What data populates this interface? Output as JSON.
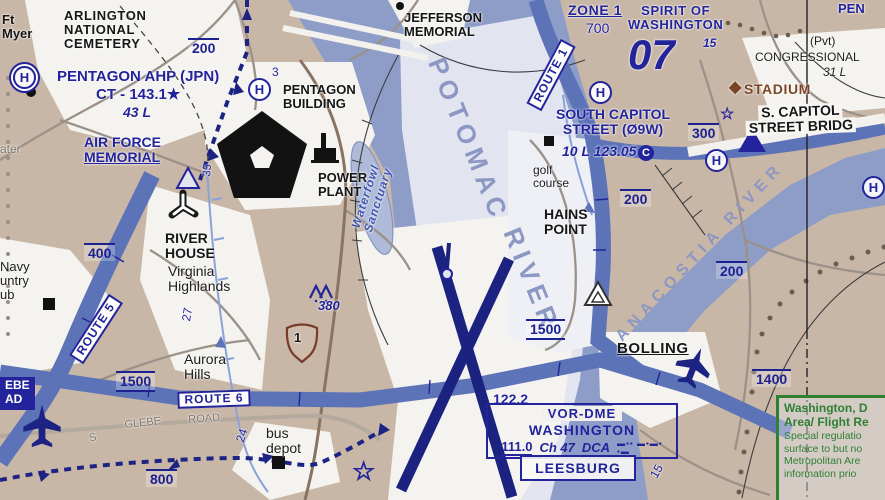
{
  "colors": {
    "land": "#c8b7a7",
    "water": "#8e9dc8",
    "corridor": "#e2e5f0",
    "urban_white": "#f4f3ef",
    "route_band": "#5c73b7",
    "navy": "#23239b",
    "runway": "#1c2280",
    "black": "#161616",
    "brown": "#7c4427",
    "green": "#2e8033",
    "gray_road": "#9b9188",
    "river_label": "#8c97c3"
  },
  "icons": {
    "helipad": "H in circle",
    "star-waypoint": "☆",
    "stadium-diamond": "◆",
    "circled-c": "C",
    "airplane": "plane silhouette",
    "obstacle": "triangle outline",
    "vfr-checkpoint": "nested triangle",
    "obstruction-mountain": "∧∧",
    "pentagon-building": "black pentagon",
    "power-plant": "black building",
    "heliport-runways": "Y shape",
    "us-route-shield": "shield",
    "building-square": "■",
    "building-dot": "●"
  },
  "vor_dme": {
    "title": "VOR-DME",
    "name": "WASHINGTON",
    "freq": "111.0",
    "channel": "Ch 47",
    "ident": "DCA",
    "morse_row1": "▬▪▪ ▬▪▬▪",
    "morse_row2": "▪▬"
  },
  "leesburg": {
    "label": "LEESBURG"
  },
  "frz_note": {
    "lines": [
      "Washington, D",
      "Area/ Flight Re",
      "Special regulatio",
      "surface to but no",
      "Metropolitan Are",
      "information prio"
    ]
  },
  "labels": [
    {
      "id": "ft-myer",
      "lines": [
        "Ft",
        "Myer"
      ],
      "x": 2,
      "y": 13,
      "cls": "c-black fs13"
    },
    {
      "id": "helipad-1",
      "text": "H",
      "x": 13,
      "y": 66,
      "cls": "hpad hpad-dbl"
    },
    {
      "id": "arlington-national-cemetery",
      "lines": [
        "ARLINGTON",
        "NATIONAL",
        "CEMETERY"
      ],
      "x": 64,
      "y": 9,
      "cls": "c-black fs13 ls1"
    },
    {
      "id": "alt-200-nw",
      "text": "200",
      "x": 188,
      "y": 38,
      "cls": "alt fs14"
    },
    {
      "id": "pentagon-ahp-name",
      "text": "PENTAGON AHP (JPN)",
      "x": 57,
      "y": 69,
      "cls": "c-navy fs15"
    },
    {
      "id": "pentagon-ahp-ct",
      "text": "CT - 143.1★",
      "x": 96,
      "y": 87,
      "cls": "c-navy fs15"
    },
    {
      "id": "pentagon-ahp-43l",
      "text": "43 L",
      "x": 123,
      "y": 105,
      "cls": "c-navy fs14 italic"
    },
    {
      "id": "helipad-2",
      "text": "H",
      "x": 248,
      "y": 78,
      "cls": "hpad"
    },
    {
      "id": "mile-3",
      "text": "3",
      "x": 272,
      "y": 66,
      "cls": "c-navy-reg fs12"
    },
    {
      "id": "pentagon-building",
      "lines": [
        "PENTAGON",
        "BUILDING"
      ],
      "x": 283,
      "y": 83,
      "cls": "c-black fs13"
    },
    {
      "id": "water-edge",
      "text": "ater",
      "x": 0,
      "y": 143,
      "cls": "c-gray fs12"
    },
    {
      "id": "air-force-memorial",
      "lines": [
        "AIR FORCE",
        "MEMORIAL"
      ],
      "x": 84,
      "y": 135,
      "cls": "c-navy fs14 u-last"
    },
    {
      "id": "power-plant",
      "lines": [
        "POWER",
        "PLANT"
      ],
      "x": 318,
      "y": 171,
      "cls": "c-black fs13"
    },
    {
      "id": "waterfowl-sanctuary",
      "lines": [
        "Waterfowl",
        "Sanctuary"
      ],
      "x": 372,
      "y": 198,
      "cls": "wf fs12",
      "rot": -72,
      "ctr": true
    },
    {
      "id": "mile-35",
      "text": "35",
      "x": 202,
      "y": 176,
      "cls": "c-navy-reg fs11",
      "rot": -85
    },
    {
      "id": "river-house",
      "lines": [
        "RIVER",
        "HOUSE"
      ],
      "x": 165,
      "y": 231,
      "cls": "c-black fs14"
    },
    {
      "id": "virginia-highlands",
      "lines": [
        "Virginia",
        "Highlands"
      ],
      "x": 168,
      "y": 264,
      "cls": "c-black-reg fs14"
    },
    {
      "id": "navy-country-club",
      "lines": [
        "Navy",
        "untry",
        "ub"
      ],
      "x": 0,
      "y": 260,
      "cls": "c-black-reg fs13"
    },
    {
      "id": "alt-400",
      "text": "400",
      "x": 84,
      "y": 243,
      "cls": "alt fs14"
    },
    {
      "id": "route-5",
      "text": "ROUTE 5",
      "x": 96,
      "y": 329,
      "cls": "route-box fs12",
      "rot": -57,
      "ctr": true
    },
    {
      "id": "mile-27",
      "text": "27",
      "x": 180,
      "y": 320,
      "cls": "c-navy-reg fs12",
      "rot": -80
    },
    {
      "id": "aurora-hills",
      "lines": [
        "Aurora",
        "Hills"
      ],
      "x": 184,
      "y": 352,
      "cls": "c-black-reg fs14"
    },
    {
      "id": "alt-1500-west",
      "text": "1500",
      "x": 116,
      "y": 371,
      "cls": "alt2 fs14"
    },
    {
      "id": "route-6",
      "text": "ROUTE 6",
      "x": 214,
      "y": 399,
      "cls": "route-box fs12",
      "rot": -2,
      "ctr": true
    },
    {
      "id": "glebe-s",
      "text": "S",
      "x": 88,
      "y": 434,
      "cls": "c-gray fs11",
      "rot": -15
    },
    {
      "id": "glebe",
      "text": "GLEBE",
      "x": 124,
      "y": 420,
      "cls": "c-gray fs11",
      "rot": -6
    },
    {
      "id": "road",
      "text": "ROAD",
      "x": 188,
      "y": 415,
      "cls": "c-gray fs11",
      "rot": -4
    },
    {
      "id": "mile-24",
      "text": "24",
      "x": 234,
      "y": 440,
      "cls": "c-navy-reg fs12",
      "rot": -72
    },
    {
      "id": "bus-depot",
      "lines": [
        "bus",
        "depot"
      ],
      "x": 266,
      "y": 426,
      "cls": "c-black-reg fs14"
    },
    {
      "id": "alt-800",
      "text": "800",
      "x": 146,
      "y": 469,
      "cls": "alt fs14"
    },
    {
      "id": "glebe-road-box",
      "lines": [
        "EBE",
        "AD"
      ],
      "x": 0,
      "y": 377,
      "cls": "glebe-box fs12"
    },
    {
      "id": "us1-number",
      "text": "1",
      "x": 294,
      "y": 331,
      "cls": "c-black fs13"
    },
    {
      "id": "mt-380",
      "text": "380",
      "x": 318,
      "y": 299,
      "cls": "c-navy fs13 italic"
    },
    {
      "id": "jefferson-memorial",
      "lines": [
        "JEFFERSON",
        "MEMORIAL"
      ],
      "x": 404,
      "y": 11,
      "cls": "c-black fs13"
    },
    {
      "id": "zone-1",
      "text": "ZONE 1",
      "x": 568,
      "y": 3,
      "cls": "c-navy fs14 underline ls1"
    },
    {
      "id": "zone-1-alt",
      "text": "700",
      "x": 586,
      "y": 21,
      "cls": "c-navy-reg fs14"
    },
    {
      "id": "route-1",
      "text": "ROUTE 1",
      "x": 551,
      "y": 75,
      "cls": "route-box fs12",
      "rot": -62,
      "ctr": true
    },
    {
      "id": "helipad-3",
      "text": "H",
      "x": 589,
      "y": 81,
      "cls": "hpad"
    },
    {
      "id": "spirit-of-washington",
      "lines": [
        "SPIRIT OF",
        "WASHINGTON"
      ],
      "x": 628,
      "y": 4,
      "cls": "c-navy fs13 tc ls1"
    },
    {
      "id": "spirit-15",
      "text": "15",
      "x": 703,
      "y": 37,
      "cls": "c-navy fs12 italic"
    },
    {
      "id": "big-07",
      "text": "07",
      "x": 628,
      "y": 36,
      "cls": "c-navy fs44 italic"
    },
    {
      "id": "pen-ne",
      "text": "PEN",
      "x": 838,
      "y": 2,
      "cls": "c-navy fs13"
    },
    {
      "id": "pvt",
      "text": "(Pvt)",
      "x": 810,
      "y": 35,
      "cls": "c-black-reg fs12"
    },
    {
      "id": "congressional",
      "text": "CONGRESSIONAL",
      "x": 755,
      "y": 51,
      "cls": "c-black-reg fs12"
    },
    {
      "id": "congressional-31l",
      "text": "31 L",
      "x": 823,
      "y": 66,
      "cls": "c-black-reg fs12 italic"
    },
    {
      "id": "stadium-diamond",
      "text": "◆",
      "x": 729,
      "y": 79,
      "cls": "c-brown fs16"
    },
    {
      "id": "stadium",
      "text": "STADIUM",
      "x": 744,
      "y": 82,
      "cls": "c-brown fs14 ls1"
    },
    {
      "id": "south-capitol-street",
      "lines": [
        "SOUTH CAPITOL",
        "STREET (Ø9W)"
      ],
      "x": 556,
      "y": 107,
      "cls": "c-navy fs14 tc"
    },
    {
      "id": "south-capitol-freq",
      "text": "10 L 123.05",
      "x": 562,
      "y": 144,
      "cls": "c-navy fs14 italic"
    },
    {
      "id": "circled-c",
      "text": "C",
      "x": 638,
      "y": 145,
      "cls": "cc"
    },
    {
      "id": "alt-300",
      "text": "300",
      "x": 688,
      "y": 123,
      "cls": "alt fs14"
    },
    {
      "id": "star-waypoint-1",
      "text": "☆",
      "x": 720,
      "y": 106,
      "cls": "star fs16"
    },
    {
      "id": "helipad-4",
      "text": "H",
      "x": 705,
      "y": 149,
      "cls": "hpad"
    },
    {
      "id": "s-capitol-street-bridge",
      "lines": [
        "S. CAPITOL",
        "STREET BRIDG"
      ],
      "x": 745,
      "y": 106,
      "cls": "c-black fs14 bridge-strip tc",
      "rot": -2
    },
    {
      "id": "helipad-5",
      "text": "H",
      "x": 862,
      "y": 176,
      "cls": "hpad"
    },
    {
      "id": "golf-course",
      "lines": [
        "golf",
        "course"
      ],
      "x": 533,
      "y": 164,
      "cls": "c-black-reg fs12"
    },
    {
      "id": "alt-200-mid",
      "text": "200",
      "x": 620,
      "y": 189,
      "cls": "alt fs14"
    },
    {
      "id": "hains-point",
      "lines": [
        "HAINS",
        "POINT"
      ],
      "x": 544,
      "y": 207,
      "cls": "c-black fs14"
    },
    {
      "id": "alt-200-east",
      "text": "200",
      "x": 716,
      "y": 261,
      "cls": "alt fs14"
    },
    {
      "id": "anacostia-river",
      "text": "ANACOSTIA RIVER",
      "x": 700,
      "y": 252,
      "cls": "river-text fs16",
      "rot": -47,
      "ctr": true
    },
    {
      "id": "potomac-word",
      "text": "POTOMAC",
      "x": 468,
      "y": 140,
      "cls": "river-text fs26",
      "rot": 68,
      "ctr": true
    },
    {
      "id": "river-word",
      "text": "RIVER",
      "x": 531,
      "y": 280,
      "cls": "river-text fs26",
      "rot": 68,
      "ctr": true
    },
    {
      "id": "alt-1500-mid",
      "text": "1500",
      "x": 526,
      "y": 319,
      "cls": "alt2 fs14"
    },
    {
      "id": "bolling",
      "text": "BOLLING",
      "x": 617,
      "y": 341,
      "cls": "c-black fs15 underline ls1"
    },
    {
      "id": "alt-1400",
      "text": "1400",
      "x": 752,
      "y": 369,
      "cls": "alt fs14"
    },
    {
      "id": "freq-122-2",
      "text": "122.2",
      "x": 493,
      "y": 392,
      "cls": "c-navy fs14"
    },
    {
      "id": "mile-15",
      "text": "15",
      "x": 648,
      "y": 474,
      "cls": "c-navy-reg fs12",
      "rot": -60
    },
    {
      "id": "star-waypoint-2",
      "text": "☆",
      "x": 352,
      "y": 458,
      "cls": "star fs26"
    }
  ]
}
